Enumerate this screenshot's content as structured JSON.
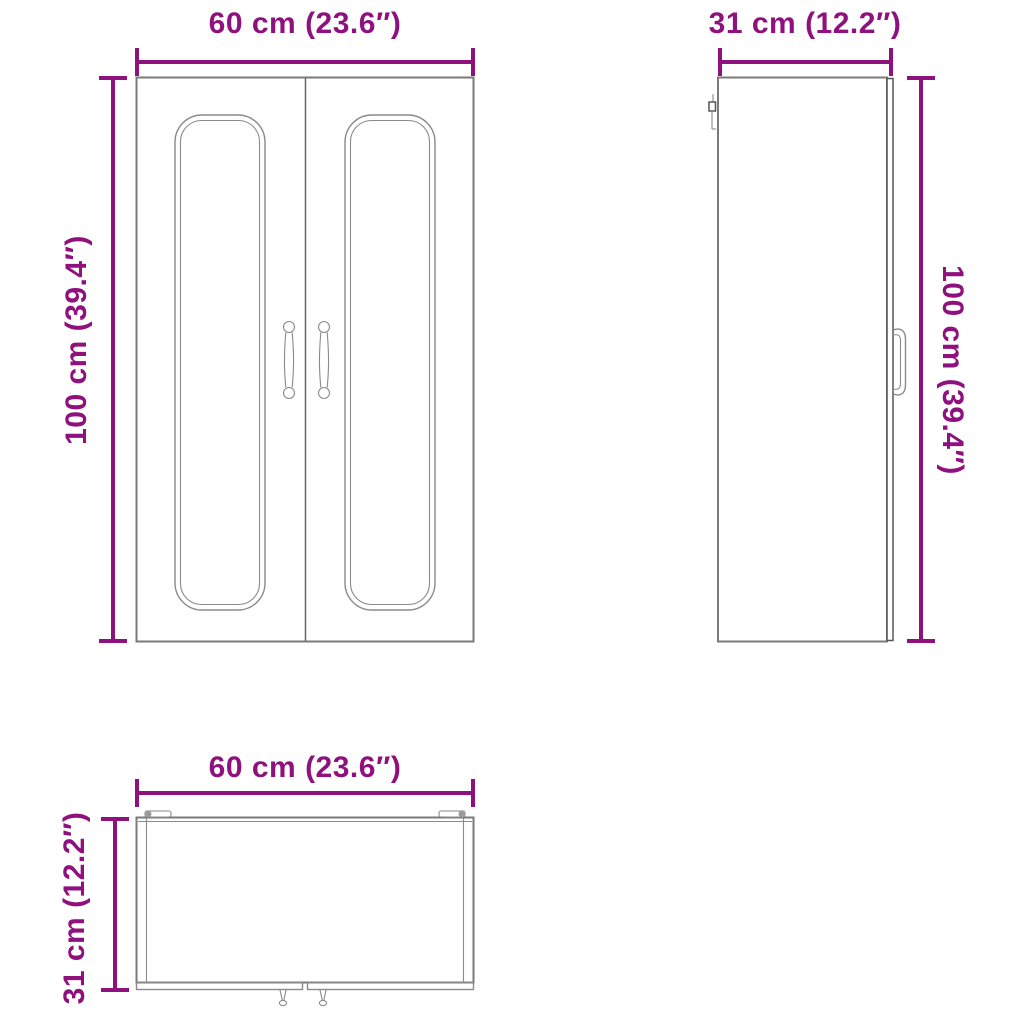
{
  "title": "Wall cabinet dimension diagram",
  "colors": {
    "dimension": "#8E117E",
    "outline": "#7a7a7a"
  },
  "views": {
    "front": {
      "label": "front view",
      "width_label": "60 cm (23.6″)",
      "height_label": "100 cm (39.4″)"
    },
    "side": {
      "label": "side view",
      "width_label": "31 cm (12.2″)",
      "height_label": "100 cm (39.4″)"
    },
    "top": {
      "label": "top view",
      "width_label": "60 cm (23.6″)",
      "depth_label": "31 cm (12.2″)"
    }
  }
}
